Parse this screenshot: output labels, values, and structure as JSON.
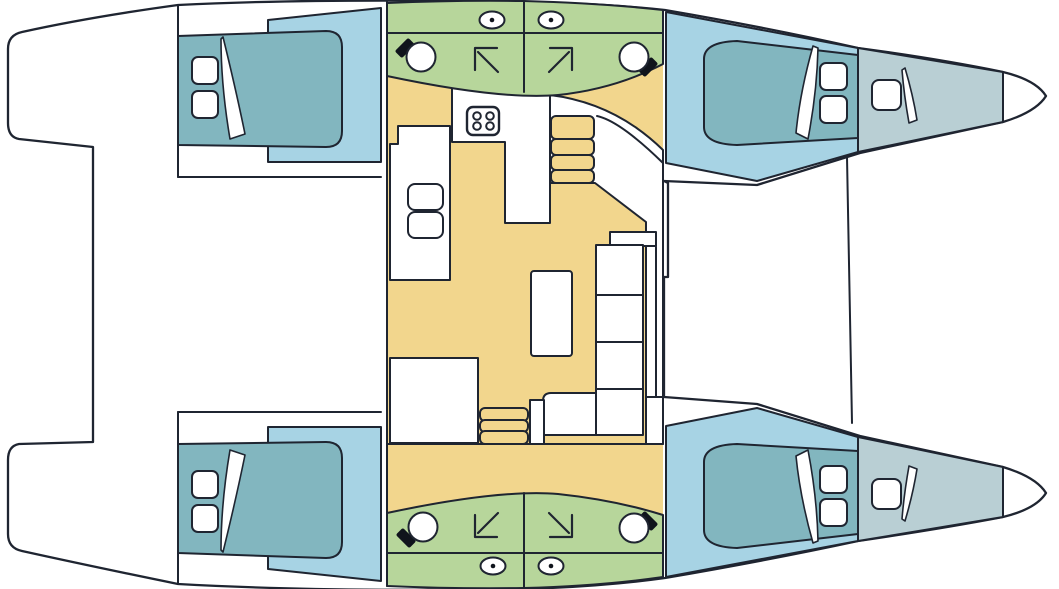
{
  "diagram": {
    "type": "floor-plan",
    "subject": "catamaran-yacht-deck-plan",
    "view": "top-down",
    "orientation": "bows-pointing-right"
  },
  "colors": {
    "background": "#ffffff",
    "outline": "#1f2531",
    "deck_white": "#ffffff",
    "cabin_floor": "#a7d3e4",
    "berth": "#82b6bf",
    "forepeak_berth": "#b9cfd4",
    "bathroom": "#b7d69b",
    "salon_floor": "#f2d68d",
    "fixture_black": "#10141c"
  },
  "icons": {
    "toilet": "ellipse-with-center-dot",
    "sink": "circle-with-black-tap",
    "shower": "corner-arrow-glyph",
    "stove": "rounded-square-four-burners",
    "berth": "mattress-with-pillows-and-folded-sheet"
  },
  "inventory": {
    "double_berth_cabins": 4,
    "forepeak_single_berths": 2,
    "bathrooms": 4,
    "toilets": 4,
    "sinks_bathroom": 4,
    "showers": 4,
    "galley_burners": 4,
    "galley_sink_bowls": 2,
    "dining_tables": 1,
    "sofa_cushions": 6,
    "companionway_step_flights": 2,
    "steps_per_flight": [
      4,
      3
    ]
  }
}
